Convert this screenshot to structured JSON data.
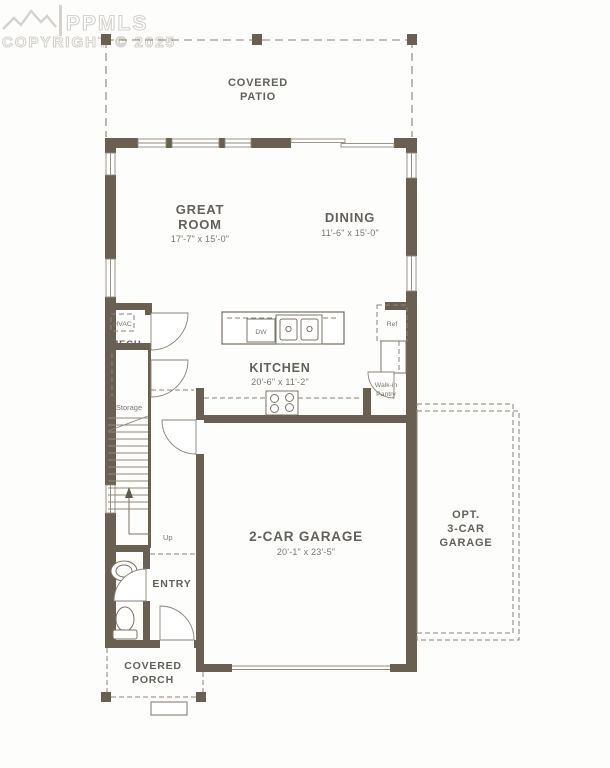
{
  "watermark": {
    "logo": "PPMLS",
    "copyright": "COPYRIGHT © 2025",
    "mountain_icon": "mountain-range-logo"
  },
  "colors": {
    "wall": "#6a6051",
    "thin_line": "#7c7366",
    "dashed_line": "#8b8376",
    "label_text": "#64605a",
    "dim_text": "#7b766e",
    "watermark": "#d5d2cc",
    "background": "#fdfdfc"
  },
  "rooms": {
    "covered_patio": {
      "line1": "COVERED",
      "line2": "PATIO"
    },
    "great_room": {
      "line1": "GREAT",
      "line2": "ROOM",
      "dims": "17'-7\" x 15'-0\""
    },
    "dining": {
      "name": "DINING",
      "dims": "11'-6\" x 15'-0\""
    },
    "kitchen": {
      "name": "KITCHEN",
      "dims": "20'-6\" x 11'-2\""
    },
    "mech": {
      "name": "MECH"
    },
    "storage": {
      "name": "Storage"
    },
    "stairs": {
      "up": "Up"
    },
    "pantry": {
      "line1": "Walk-in",
      "line2": "Pantry"
    },
    "pwdr": {
      "name": "PWDR"
    },
    "entry": {
      "name": "ENTRY"
    },
    "garage": {
      "name": "2-CAR GARAGE",
      "dims": "20'-1\" x 23'-5\""
    },
    "opt_garage": {
      "line1": "OPT.",
      "line2": "3-CAR",
      "line3": "GARAGE"
    },
    "covered_porch": {
      "line1": "COVERED",
      "line2": "PORCH"
    }
  },
  "fixtures": {
    "hvac": "HVAC",
    "dishwasher": "DW",
    "refrigerator": "Ref"
  }
}
